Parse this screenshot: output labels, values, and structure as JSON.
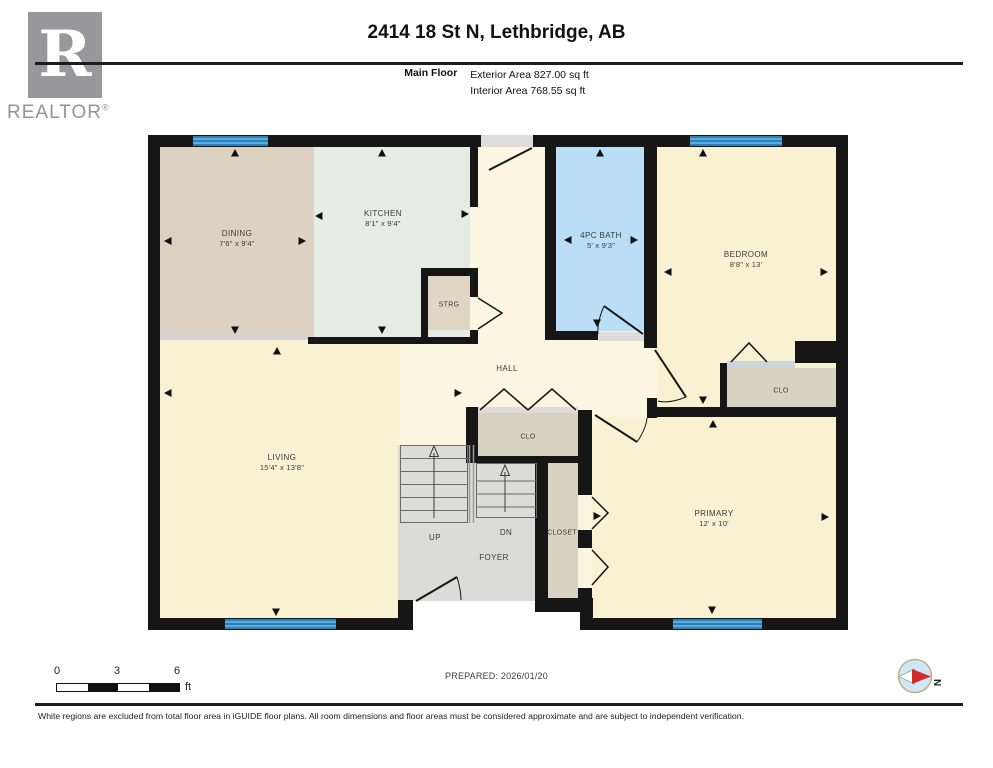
{
  "header": {
    "title": "2414 18 St N, Lethbridge, AB",
    "floor_label": "Main Floor",
    "exterior_area": "Exterior Area 827.00 sq ft",
    "interior_area": "Interior Area 768.55 sq ft"
  },
  "branding": {
    "realtor_logo_letter": "R",
    "realtor_text": "REALTOR",
    "registered_mark": "®"
  },
  "rooms": {
    "dining": {
      "name": "DINING",
      "dims": "7'6\" x 9'4\""
    },
    "kitchen": {
      "name": "KITCHEN",
      "dims": "8'1\" x 9'4\""
    },
    "strg": {
      "name": "STRG"
    },
    "bath": {
      "name": "4PC BATH",
      "dims": "5' x 9'3\""
    },
    "bedroom": {
      "name": "BEDROOM",
      "dims": "8'8\" x 13'"
    },
    "hall": {
      "name": "HALL"
    },
    "clo_hall": {
      "name": "CLO"
    },
    "clo_bedroom": {
      "name": "CLO"
    },
    "living": {
      "name": "LIVING",
      "dims": "15'4\" x 13'8\""
    },
    "up": {
      "name": "UP"
    },
    "dn": {
      "name": "DN"
    },
    "closet": {
      "name": "CLOSET"
    },
    "foyer": {
      "name": "FOYER"
    },
    "primary": {
      "name": "PRIMARY",
      "dims": "12' x 10'"
    }
  },
  "scale_bar": {
    "ticks": [
      "0",
      "3",
      "6"
    ],
    "unit": "ft"
  },
  "compass": {
    "north_label": "N"
  },
  "footer": {
    "prepared": "PREPARED: 2026/01/20",
    "disclaimer": "White regions are excluded from total floor area in iGUIDE floor plans. All room dimensions and floor areas must be considered approximate and are subject to independent verification."
  },
  "colors": {
    "wall": "#161616",
    "window_blue": "#57aede",
    "window_stripe": "#2f7fb6",
    "cream": "#fcf6e0",
    "room_yellow": "#faf1d3",
    "dining_tan": "#ddd2c1",
    "kitchen_green": "#e5ece4",
    "bath_blue": "#b9def5",
    "floor_gray": "#dbdbd9",
    "closet_tan": "#d9d2c3",
    "strg_tan": "#e0d6c3"
  }
}
